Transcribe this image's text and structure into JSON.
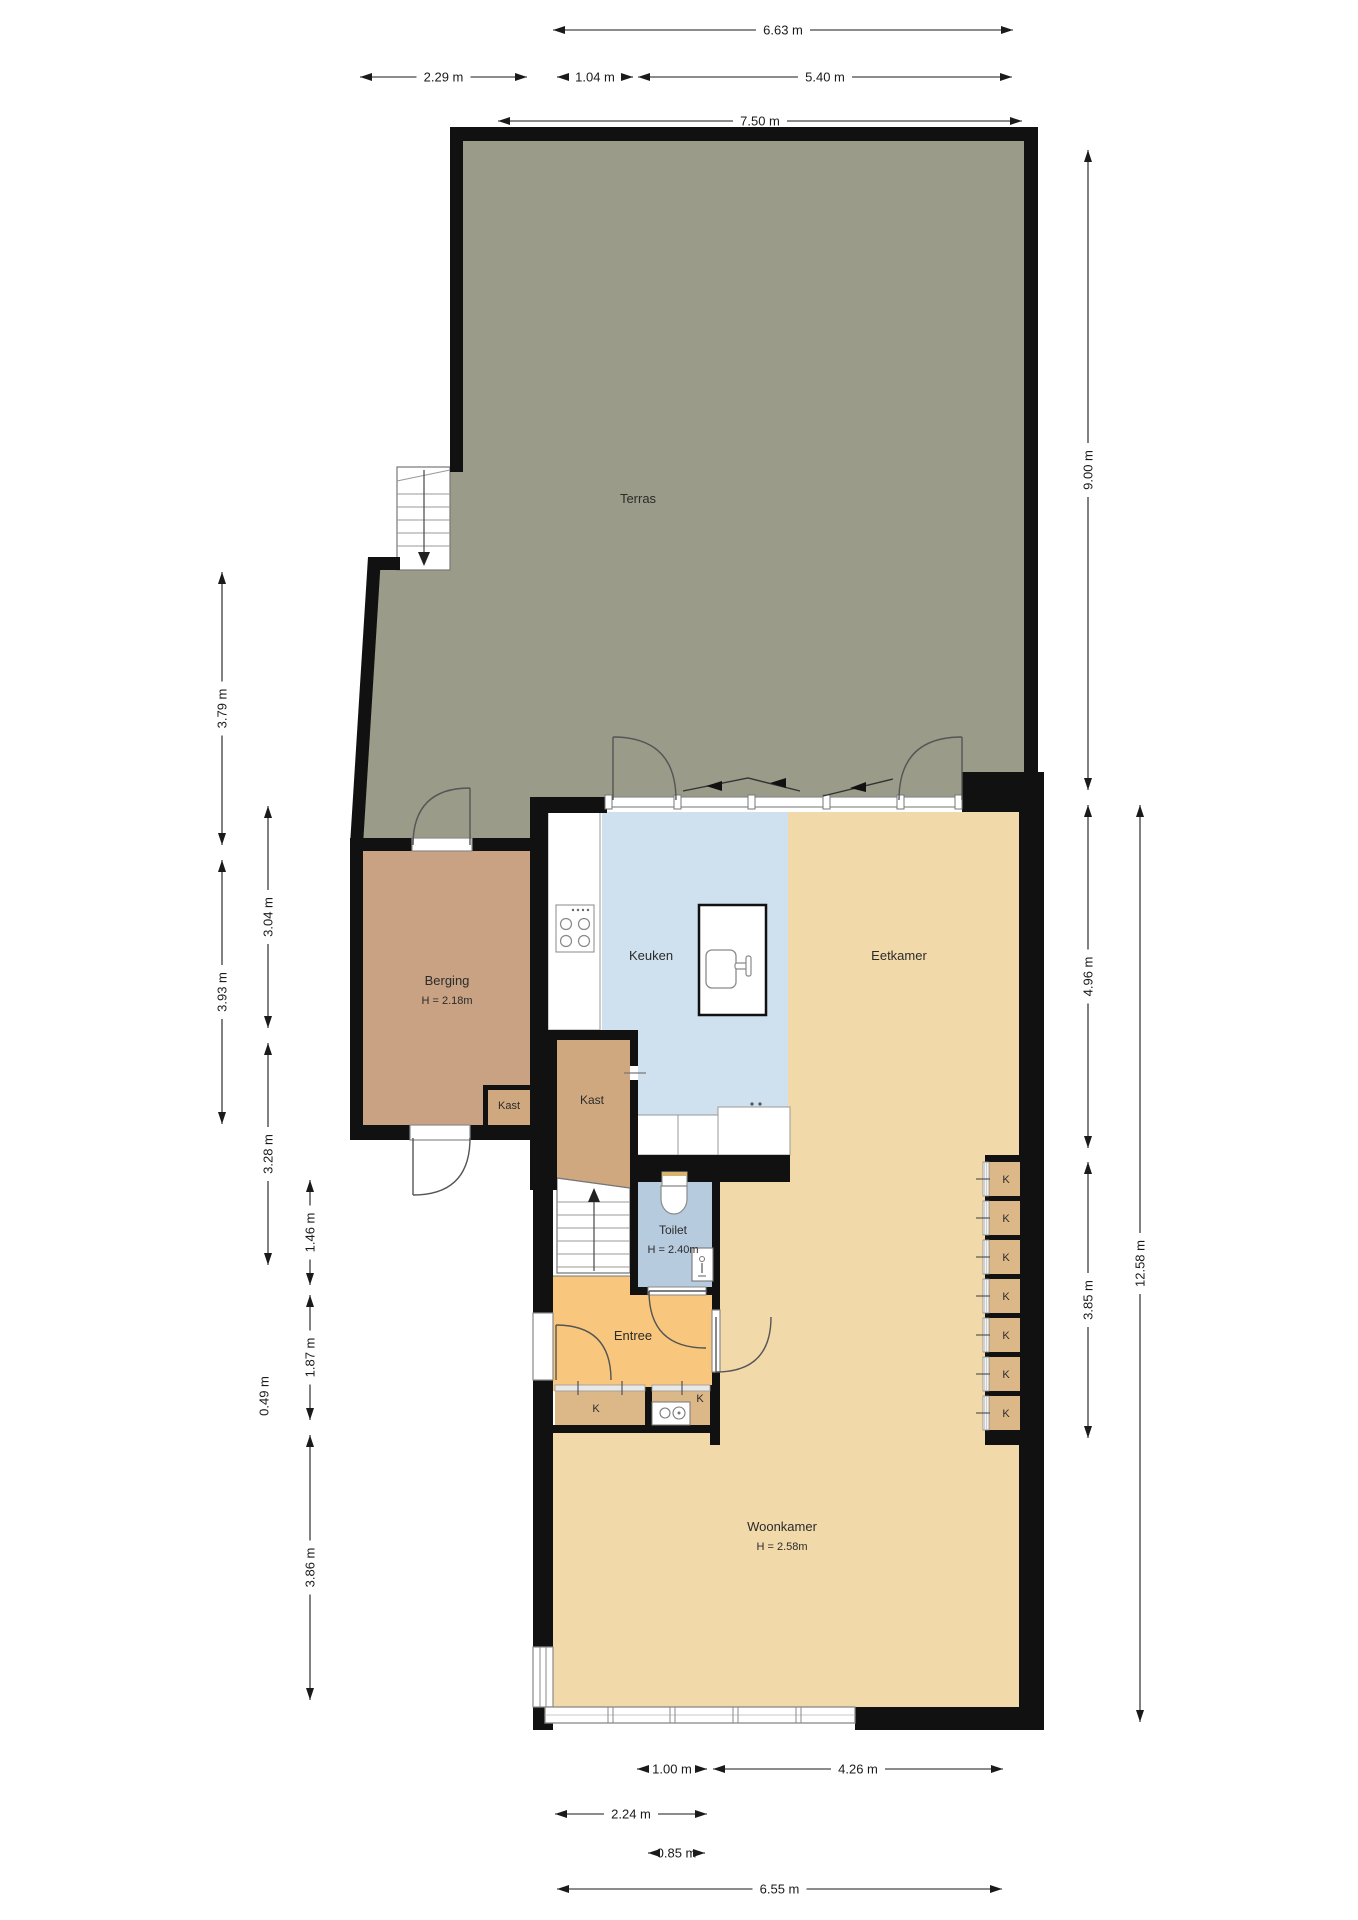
{
  "plan_title": "Begane grond plattegrond",
  "colors": {
    "wall": "#111111",
    "terras": "#9a9b89",
    "berging": "#c8a283",
    "kast": "#cfa87f",
    "k_closet": "#dcb888",
    "keuken": "#cfe0ee",
    "toilet": "#b7cbdf",
    "living": "#f2d9aa",
    "entree": "#f8c77d",
    "counter_border": "#999999",
    "frame": "#8a8a8a",
    "door_arc": "#555555",
    "dim_text": "#1a1a1a",
    "room_text": "#2b2b2b"
  },
  "rooms": [
    {
      "id": "terras",
      "label": "Terras",
      "x": 638,
      "y": 503,
      "fs": 13
    },
    {
      "id": "berging",
      "label": "Berging",
      "sub": "H = 2.18m",
      "x": 447,
      "y": 985,
      "fs": 13
    },
    {
      "id": "kast-small",
      "label": "Kast",
      "x": 509,
      "y": 1109,
      "fs": 11
    },
    {
      "id": "kast-big",
      "label": "Kast",
      "x": 592,
      "y": 1104,
      "fs": 12
    },
    {
      "id": "keuken",
      "label": "Keuken",
      "x": 651,
      "y": 960,
      "fs": 13
    },
    {
      "id": "eetkamer",
      "label": "Eetkamer",
      "x": 899,
      "y": 960,
      "fs": 13
    },
    {
      "id": "toilet",
      "label": "Toilet",
      "sub": "H = 2.40m",
      "x": 673,
      "y": 1234,
      "fs": 12
    },
    {
      "id": "entree",
      "label": "Entree",
      "x": 633,
      "y": 1340,
      "fs": 13
    },
    {
      "id": "woonkamer",
      "label": "Woonkamer",
      "sub": "H = 2.58m",
      "x": 782,
      "y": 1531,
      "fs": 13
    },
    {
      "id": "k-entree-left",
      "label": "K",
      "x": 596,
      "y": 1412,
      "fs": 11
    },
    {
      "id": "k-entree-right",
      "label": "K",
      "x": 700,
      "y": 1402,
      "fs": 11
    }
  ],
  "k_closets": {
    "label": "K",
    "count": 7,
    "x_strip": 983,
    "x_box": 989,
    "box_w": 31,
    "y_start": 1162,
    "cell_h": 34,
    "pitch": 39
  },
  "dimensions": {
    "top": [
      {
        "label": "6.63 m",
        "y": 30,
        "a": 553,
        "b": 1013
      },
      {
        "label": "2.29 m",
        "y": 77,
        "a": 360,
        "b": 527
      },
      {
        "label": "1.04 m",
        "y": 77,
        "a": 557,
        "b": 633
      },
      {
        "label": "5.40 m",
        "y": 77,
        "a": 638,
        "b": 1012
      },
      {
        "label": "7.50 m",
        "y": 121,
        "a": 498,
        "b": 1022
      }
    ],
    "bottom": [
      {
        "label": "1.00 m",
        "y": 1769,
        "a": 637,
        "b": 707
      },
      {
        "label": "4.26 m",
        "y": 1769,
        "a": 713,
        "b": 1003
      },
      {
        "label": "2.24 m",
        "y": 1814,
        "a": 555,
        "b": 707
      },
      {
        "label": "0.85 m",
        "y": 1853,
        "a": 648,
        "b": 705
      },
      {
        "label": "6.55 m",
        "y": 1889,
        "a": 557,
        "b": 1002
      }
    ],
    "left": [
      {
        "label": "3.79 m",
        "x": 222,
        "a": 572,
        "b": 845
      },
      {
        "label": "3.93 m",
        "x": 222,
        "a": 860,
        "b": 1124
      },
      {
        "label": "3.04 m",
        "x": 268,
        "a": 806,
        "b": 1028
      },
      {
        "label": "3.28 m",
        "x": 268,
        "a": 1043,
        "b": 1265
      },
      {
        "label": "1.46 m",
        "x": 310,
        "a": 1180,
        "b": 1285
      },
      {
        "label": "1.87 m",
        "x": 310,
        "a": 1295,
        "b": 1420
      },
      {
        "label": "0.49 m",
        "x": 264,
        "a": 1362,
        "b": 1430,
        "text_only": true
      },
      {
        "label": "3.86 m",
        "x": 310,
        "a": 1435,
        "b": 1700
      }
    ],
    "right": [
      {
        "label": "9.00 m",
        "x": 1088,
        "a": 150,
        "b": 790
      },
      {
        "label": "4.96 m",
        "x": 1088,
        "a": 805,
        "b": 1148
      },
      {
        "label": "3.85 m",
        "x": 1088,
        "a": 1162,
        "b": 1438
      },
      {
        "label": "12.58 m",
        "x": 1140,
        "a": 805,
        "b": 1722
      }
    ]
  }
}
